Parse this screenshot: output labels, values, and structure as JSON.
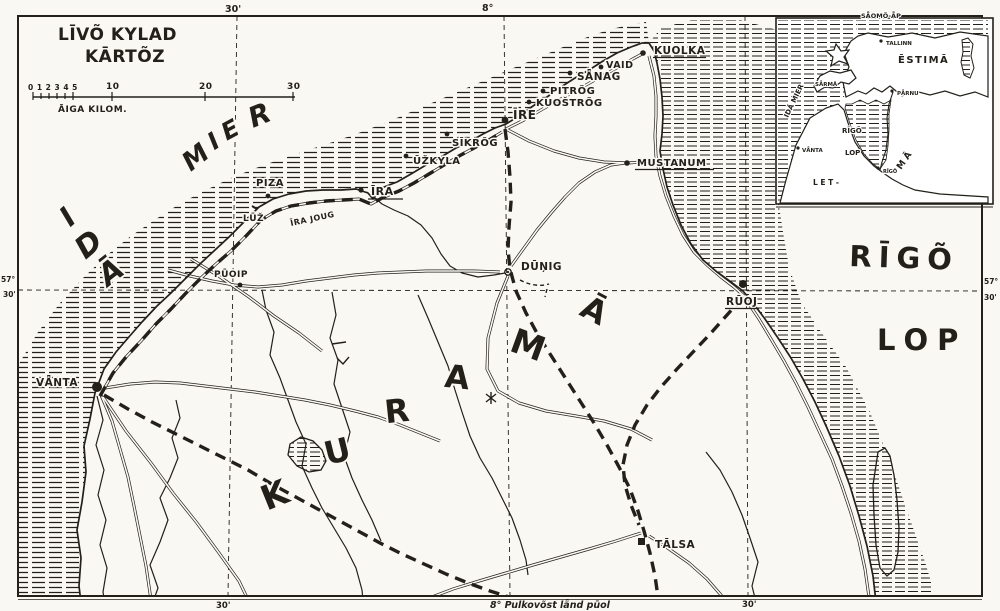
{
  "colors": {
    "paper": "#faf8f3",
    "ink": "#23201a"
  },
  "title": {
    "line1": "LĪVÕ KYLAD",
    "line2": "KĀRTÕZ"
  },
  "scale_bar": {
    "minor_ticks": "0 1 2 3 4 5",
    "k10": "10",
    "k20": "20",
    "k30": "30",
    "unit": "ĀIGA KILOM."
  },
  "grid": {
    "top_min": "30'",
    "top_deg": "8°",
    "left_deg": "57°",
    "left_min": "30'",
    "right_deg": "57°",
    "right_min": "30'",
    "bottom_min_left": "30'",
    "bottom_min_right": "30'",
    "bottom_note": "8° Pulkovõst lǟnd pūol"
  },
  "seas": {
    "ida": {
      "l0": "I",
      "l1": "D",
      "l2": "Ā"
    },
    "mier": {
      "l0": "M",
      "l1": "I",
      "l2": "E",
      "l3": "R"
    },
    "rigo": "RĪGÕ",
    "lop": "LOP"
  },
  "region": {
    "kurama": {
      "l0": "K",
      "l1": "U",
      "l2": "R",
      "l3": "A",
      "l4": "M",
      "l5": "Ā"
    }
  },
  "places": {
    "piza": "PIZA",
    "luz": "LŪŽ",
    "ira": "ĪRA",
    "ira_joug": "ĪRA JOUG",
    "uzkyla": "ŪŽKYLA",
    "sikrog": "SĪKRÕG",
    "ire": "ĪRE",
    "pitrog": "PITRÕG",
    "kuostrog": "KUOŠTRÕG",
    "sanag": "SǞNAG",
    "vaid": "VAID",
    "kuolka": "KUOLKA",
    "mustanum": "MUSTANUM",
    "puoip": "PŪOIP",
    "dunig": "DŪŅIG",
    "ruoj": "RŪOJ",
    "vanta": "VǞNTA",
    "talsa": "TĀLSA"
  },
  "inset": {
    "saomo": "SǞOMÕ-ǞP",
    "tallinn": "TALLINN",
    "estima": "ĒSTIMĀ",
    "parnu": "PǞRNU",
    "sarma": "SǞRMĀ",
    "rigo_gulf": "RĪGÕ",
    "lop_gulf": "LOP",
    "rigo_city": "RĪGÕ",
    "vanta": "VǞNTA",
    "letma_left": "L E T -",
    "letma_right": "M Ā",
    "ida_mier": "IDĀ MIER"
  }
}
